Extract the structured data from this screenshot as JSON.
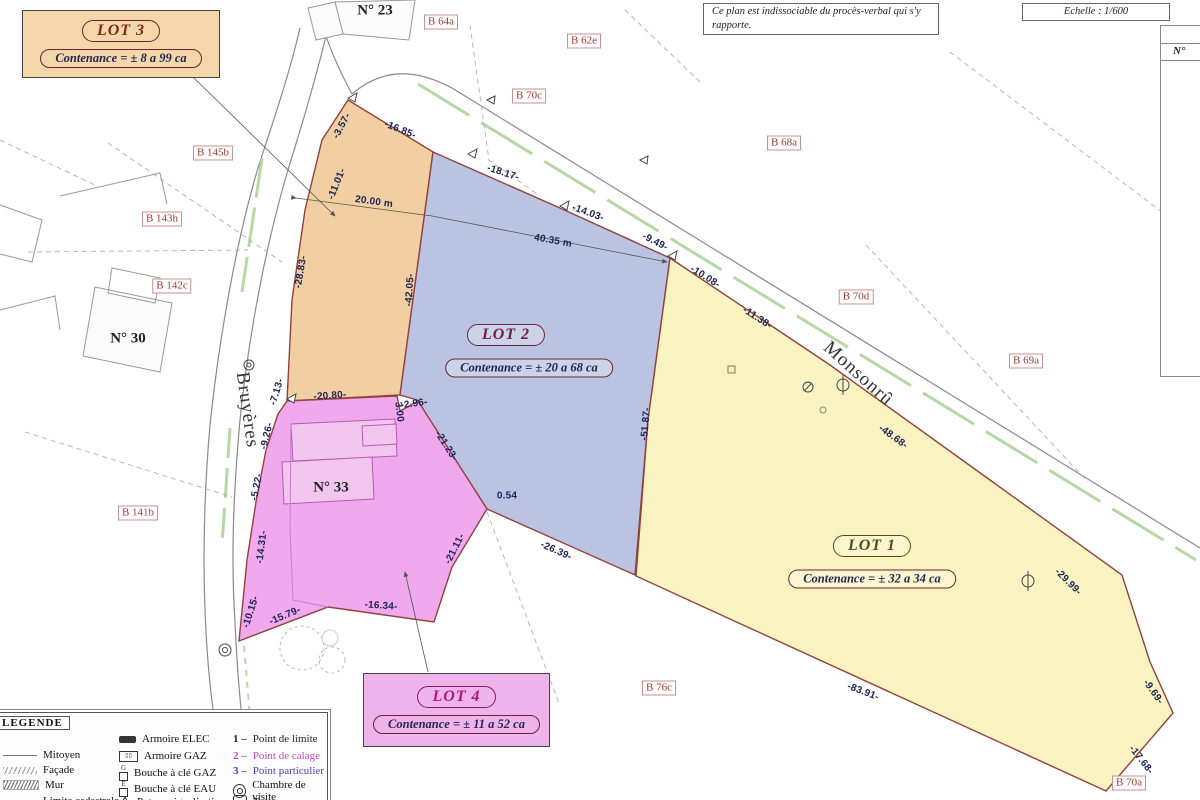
{
  "header": {
    "note": "Ce plan est indissociable du procès-verbal qui s'y rapporte.",
    "scale": "Echelle : 1/600"
  },
  "side_table": {
    "header": "N°"
  },
  "lots": [
    {
      "label": "LOT 1",
      "contenance": "Contenance = ± 32 a 34 ca"
    },
    {
      "label": "LOT 2",
      "contenance": "Contenance = ± 20 a 68 ca"
    },
    {
      "label": "LOT 3",
      "contenance": "Contenance = ± 8 a 99 ca"
    },
    {
      "label": "LOT 4",
      "contenance": "Contenance = ± 11 a 52 ca"
    }
  ],
  "streets": [
    {
      "name": "Bruyères",
      "x": 247,
      "y": 410,
      "r": 82
    },
    {
      "name": "Monsonrû",
      "x": 858,
      "y": 374,
      "r": 42
    }
  ],
  "parcel_labels": [
    {
      "t": "B 64a",
      "x": 441,
      "y": 22
    },
    {
      "t": "B 62e",
      "x": 584,
      "y": 41
    },
    {
      "t": "B 70c",
      "x": 529,
      "y": 96
    },
    {
      "t": "B 68a",
      "x": 784,
      "y": 143
    },
    {
      "t": "B 145b",
      "x": 213,
      "y": 153
    },
    {
      "t": "B 143h",
      "x": 162,
      "y": 219
    },
    {
      "t": "B 142c",
      "x": 172,
      "y": 286
    },
    {
      "t": "B 70d",
      "x": 856,
      "y": 297
    },
    {
      "t": "B 69a",
      "x": 1026,
      "y": 361
    },
    {
      "t": "B 141b",
      "x": 138,
      "y": 513
    },
    {
      "t": "B 76c",
      "x": 659,
      "y": 688
    },
    {
      "t": "B 70a",
      "x": 1129,
      "y": 783
    }
  ],
  "house_labels": [
    {
      "t": "N° 23",
      "x": 375,
      "y": 11
    },
    {
      "t": "N° 30",
      "x": 128,
      "y": 339
    },
    {
      "t": "N° 33",
      "x": 331,
      "y": 488
    }
  ],
  "measurements": [
    {
      "t": "-3.57-",
      "x": 342,
      "y": 126,
      "r": -62
    },
    {
      "t": "-16.85-",
      "x": 400,
      "y": 130,
      "r": 22
    },
    {
      "t": "-11.01-",
      "x": 337,
      "y": 184,
      "r": -68
    },
    {
      "t": "-18.17-",
      "x": 503,
      "y": 173,
      "r": 18
    },
    {
      "t": "20.00 m",
      "x": 374,
      "y": 202,
      "r": 8
    },
    {
      "t": "-14.03-",
      "x": 588,
      "y": 213,
      "r": 20
    },
    {
      "t": "40.35 m",
      "x": 553,
      "y": 241,
      "r": 10
    },
    {
      "t": "-9.49-",
      "x": 655,
      "y": 242,
      "r": 27
    },
    {
      "t": "-10.08-",
      "x": 705,
      "y": 277,
      "r": 32
    },
    {
      "t": "-11.38-",
      "x": 757,
      "y": 318,
      "r": 33
    },
    {
      "t": "-28.83-",
      "x": 301,
      "y": 272,
      "r": -80
    },
    {
      "t": "-42.05-",
      "x": 410,
      "y": 290,
      "r": -86
    },
    {
      "t": "-7.13-",
      "x": 277,
      "y": 392,
      "r": -73
    },
    {
      "t": "-20.80-",
      "x": 330,
      "y": 396,
      "r": -4
    },
    {
      "t": "-2.96-",
      "x": 414,
      "y": 404,
      "r": -8
    },
    {
      "t": "3.00",
      "x": 399,
      "y": 412,
      "r": 83
    },
    {
      "t": "-9.26-",
      "x": 267,
      "y": 436,
      "r": -76
    },
    {
      "t": "-21.23-",
      "x": 446,
      "y": 446,
      "r": 57
    },
    {
      "t": "-51.87-",
      "x": 646,
      "y": 424,
      "r": -85
    },
    {
      "t": "-5.22-",
      "x": 257,
      "y": 487,
      "r": -79
    },
    {
      "t": "0.54",
      "x": 507,
      "y": 496,
      "r": 0
    },
    {
      "t": "-14.31-",
      "x": 262,
      "y": 547,
      "r": -83
    },
    {
      "t": "-21.11-",
      "x": 455,
      "y": 549,
      "r": -63
    },
    {
      "t": "-26.39-",
      "x": 556,
      "y": 551,
      "r": 24
    },
    {
      "t": "-48.68-",
      "x": 893,
      "y": 437,
      "r": 36
    },
    {
      "t": "-29.99-",
      "x": 1068,
      "y": 582,
      "r": 45
    },
    {
      "t": "-10.15-",
      "x": 251,
      "y": 612,
      "r": -72
    },
    {
      "t": "-15.79-",
      "x": 285,
      "y": 616,
      "r": -23
    },
    {
      "t": "-16.34-",
      "x": 381,
      "y": 606,
      "r": 4
    },
    {
      "t": "-83.91-",
      "x": 863,
      "y": 692,
      "r": 21
    },
    {
      "t": "-9.69-",
      "x": 1153,
      "y": 692,
      "r": 55
    },
    {
      "t": "-17.68-",
      "x": 1141,
      "y": 760,
      "r": 52
    }
  ],
  "legend": {
    "title": "LEGENDE",
    "left": [
      "Mitoyen",
      "Façade",
      "Mur",
      "Limite cadastrale"
    ],
    "middle": [
      "Armoire ELEC",
      "Armoire GAZ",
      "Bouche à clé GAZ",
      "Bouche à clé EAU",
      "Poteau signalisation"
    ],
    "points": [
      {
        "num": "1 –",
        "label": "Point de limite"
      },
      {
        "num": "2 –",
        "label": "Point de calage"
      },
      {
        "num": "3 –",
        "label": "Point particulier"
      }
    ],
    "extra": [
      "Chambre de visite",
      "Taque"
    ],
    "gaz_glyph": "G",
    "eau_glyph": "E"
  },
  "colors": {
    "lot1_fill": "#f8f3c0",
    "lot2_fill": "#bac4e2",
    "lot3_fill": "#f2cfa2",
    "lot4_fill": "#efa9ec",
    "lot4_building": "#f3c6f0",
    "boundary": "#94403c",
    "road": "#8a8a8a",
    "vegetation": "#aed49a",
    "measure_text": "#1c2255",
    "parcel_text": "#a03c30"
  }
}
